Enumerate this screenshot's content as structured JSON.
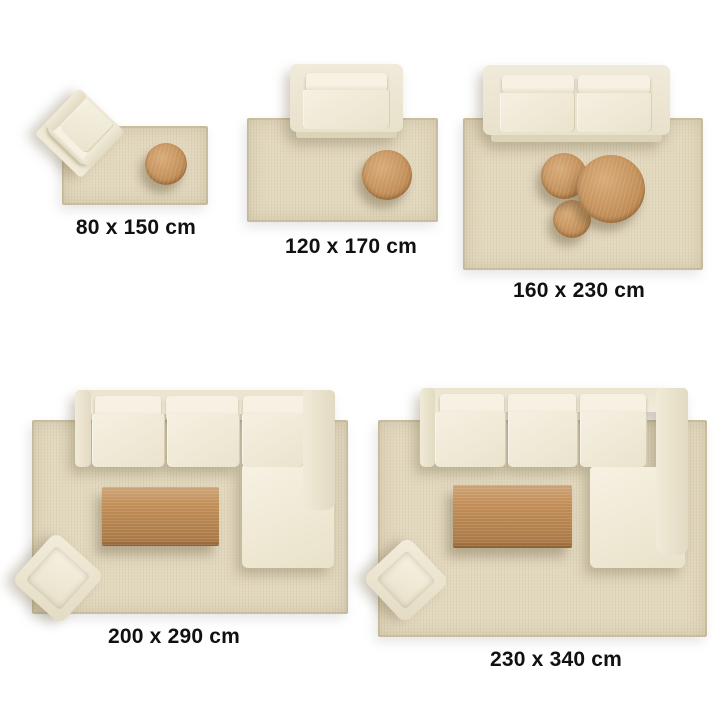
{
  "title": "Rug size guide (top view room layouts)",
  "colors": {
    "background": "#ffffff",
    "rug": "#e3d9bf",
    "sofa-shell": "#ece5d1",
    "sofa-cushion": "#f4efe0",
    "wood": "#c28e58",
    "wood-light": "#d8ab79",
    "wood-dark": "#a3713c",
    "label-text": "#111111"
  },
  "panels": [
    {
      "id": "80x150",
      "label": "80 x 150 cm",
      "width_cm": 80,
      "length_cm": 150,
      "furniture": [
        "armchair",
        "round-side-table"
      ]
    },
    {
      "id": "120x170",
      "label": "120 x 170 cm",
      "width_cm": 120,
      "length_cm": 170,
      "furniture": [
        "loveseat-sofa",
        "round-coffee-table"
      ]
    },
    {
      "id": "160x230",
      "label": "160 x 230 cm",
      "width_cm": 160,
      "length_cm": 230,
      "furniture": [
        "two-seat-sofa",
        "nesting-round-coffee-tables"
      ]
    },
    {
      "id": "200x290",
      "label": "200 x 290 cm",
      "width_cm": 200,
      "length_cm": 290,
      "furniture": [
        "l-shaped-sectional-sofa",
        "rectangular-coffee-table",
        "ottoman"
      ]
    },
    {
      "id": "230x340",
      "label": "230 x 340 cm",
      "width_cm": 230,
      "length_cm": 340,
      "furniture": [
        "l-shaped-sectional-sofa",
        "rectangular-coffee-table",
        "ottoman"
      ]
    }
  ]
}
